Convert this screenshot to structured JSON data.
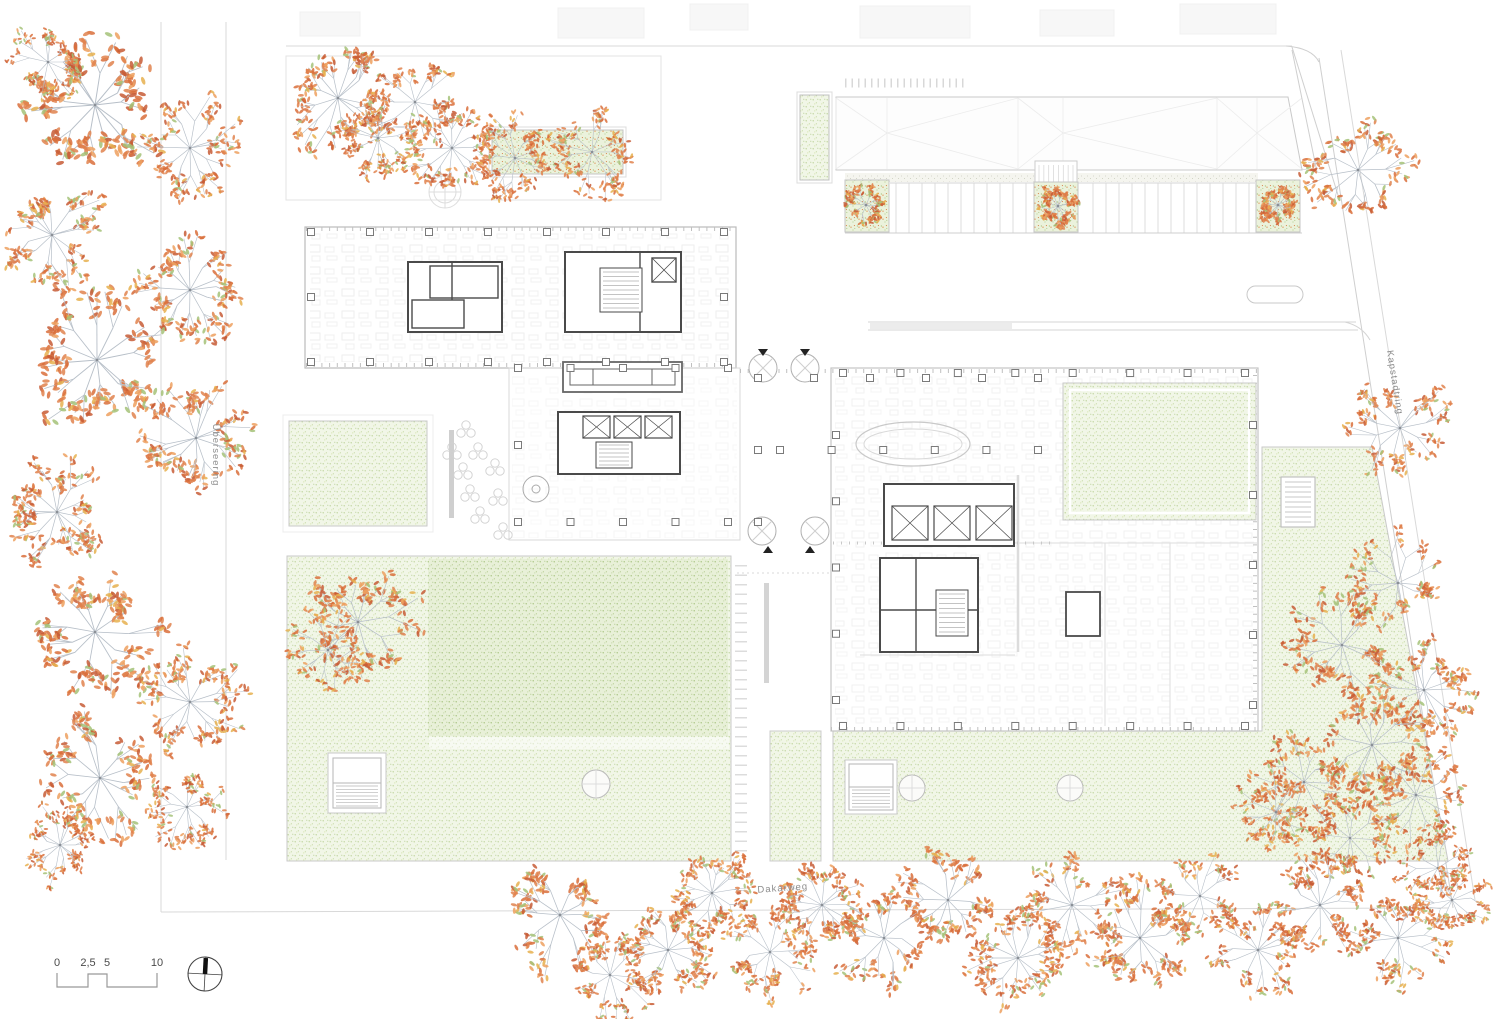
{
  "labels": {
    "street_left": "Überseering",
    "street_right": "Kapstadtring",
    "street_bottom": "Dakarweg"
  },
  "scale_bar": {
    "ticks": [
      "0",
      "2,5",
      "5",
      "10"
    ]
  },
  "colors": {
    "line": "#c9c9c9",
    "wall": "#4a4a4a",
    "grass_base": "#f1f6e7",
    "grass_dot": "#b8cf92",
    "grass_dark_base": "#e8f0d8",
    "branch": "#b7bfc8",
    "leaf_palette": [
      "#e0834e",
      "#d96f3b",
      "#c75c36",
      "#eda05f",
      "#a4c278",
      "#e6b04f"
    ]
  },
  "trees": [
    [
      95,
      105,
      82,
      1
    ],
    [
      48,
      62,
      40,
      2
    ],
    [
      190,
      148,
      56,
      3
    ],
    [
      52,
      235,
      58,
      4
    ],
    [
      190,
      290,
      62,
      5
    ],
    [
      97,
      360,
      76,
      6
    ],
    [
      196,
      438,
      62,
      7
    ],
    [
      57,
      512,
      58,
      8
    ],
    [
      95,
      632,
      72,
      9
    ],
    [
      190,
      702,
      58,
      10
    ],
    [
      100,
      778,
      68,
      11
    ],
    [
      187,
      807,
      48,
      12
    ],
    [
      60,
      845,
      42,
      13
    ],
    [
      338,
      98,
      60,
      14
    ],
    [
      415,
      102,
      52,
      15
    ],
    [
      378,
      138,
      46,
      16
    ],
    [
      452,
      148,
      54,
      17
    ],
    [
      515,
      158,
      48,
      18
    ],
    [
      592,
      152,
      50,
      19
    ],
    [
      866,
      205,
      21,
      20
    ],
    [
      1058,
      206,
      21,
      21
    ],
    [
      1278,
      205,
      21,
      22
    ],
    [
      358,
      622,
      62,
      23
    ],
    [
      328,
      650,
      50,
      24
    ],
    [
      1358,
      170,
      58,
      25
    ],
    [
      1400,
      428,
      55,
      26
    ],
    [
      1398,
      583,
      54,
      27
    ],
    [
      1342,
      645,
      58,
      28
    ],
    [
      1424,
      690,
      55,
      29
    ],
    [
      1372,
      745,
      62,
      30
    ],
    [
      1304,
      782,
      54,
      31
    ],
    [
      1416,
      795,
      55,
      32
    ],
    [
      1350,
      838,
      50,
      33
    ],
    [
      1276,
      812,
      48,
      34
    ],
    [
      1438,
      868,
      44,
      35
    ],
    [
      560,
      915,
      64,
      36
    ],
    [
      610,
      975,
      48,
      37
    ],
    [
      668,
      950,
      55,
      38
    ],
    [
      712,
      893,
      50,
      39
    ],
    [
      770,
      952,
      50,
      40
    ],
    [
      822,
      905,
      52,
      41
    ],
    [
      884,
      938,
      58,
      42
    ],
    [
      948,
      900,
      60,
      43
    ],
    [
      1018,
      958,
      54,
      44
    ],
    [
      1072,
      905,
      55,
      45
    ],
    [
      1140,
      938,
      58,
      46
    ],
    [
      1200,
      896,
      50,
      47
    ],
    [
      1258,
      950,
      54,
      48
    ],
    [
      1320,
      905,
      54,
      49
    ],
    [
      1398,
      938,
      54,
      50
    ],
    [
      1452,
      900,
      40,
      51
    ]
  ],
  "columns": {
    "h": [
      {
        "y": 232,
        "x0": 311,
        "x1": 724,
        "n": 8
      },
      {
        "y": 362,
        "x0": 311,
        "x1": 724,
        "n": 8
      },
      {
        "y": 368,
        "x0": 518,
        "x1": 728,
        "n": 5
      },
      {
        "y": 522,
        "x0": 518,
        "x1": 728,
        "n": 5
      },
      {
        "y": 378,
        "x0": 758,
        "x1": 1038,
        "n": 6
      },
      {
        "y": 450,
        "x0": 780,
        "x1": 1038,
        "n": 6
      },
      {
        "y": 373,
        "x0": 843,
        "x1": 1245,
        "n": 8
      },
      {
        "y": 726,
        "x0": 843,
        "x1": 1245,
        "n": 8
      }
    ],
    "v": [
      {
        "x": 311,
        "y0": 232,
        "y1": 362,
        "n": 3
      },
      {
        "x": 724,
        "y0": 232,
        "y1": 362,
        "n": 3
      },
      {
        "x": 518,
        "y0": 368,
        "y1": 522,
        "n": 3
      },
      {
        "x": 758,
        "y0": 378,
        "y1": 522,
        "n": 3
      },
      {
        "x": 836,
        "y0": 435,
        "y1": 700,
        "n": 5
      },
      {
        "x": 1253,
        "y0": 425,
        "y1": 705,
        "n": 5
      }
    ]
  }
}
